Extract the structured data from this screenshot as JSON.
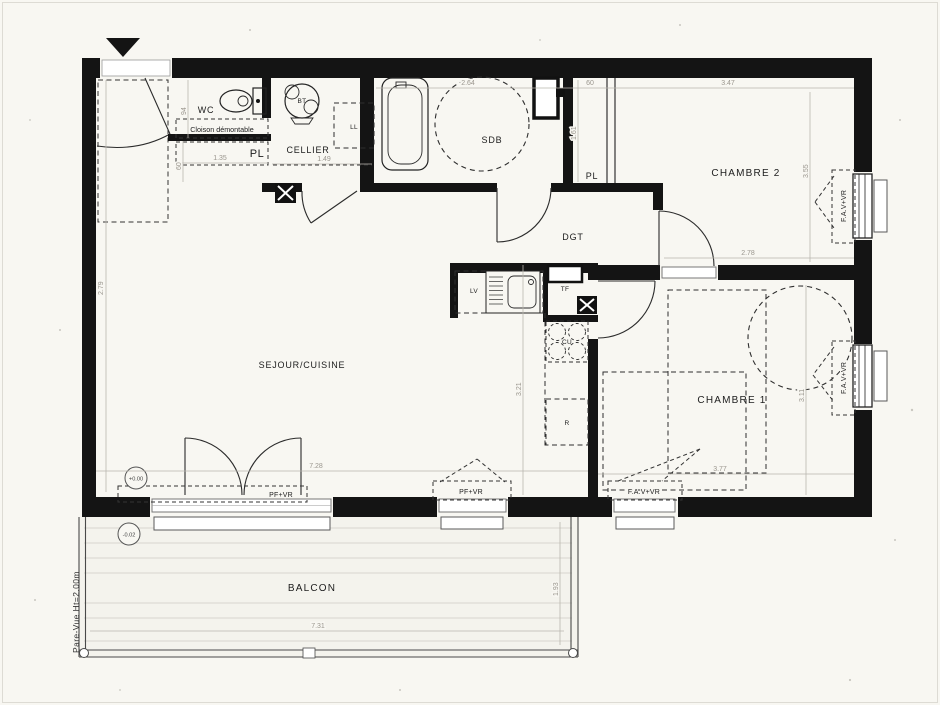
{
  "plan": {
    "rooms": {
      "sejour": "SEJOUR/CUISINE",
      "chambre1": "CHAMBRE 1",
      "chambre2": "CHAMBRE 2",
      "sdb": "SDB",
      "wc": "WC",
      "cellier": "CELLIER",
      "dgt": "DGT",
      "balcon": "BALCON",
      "pl_entry": "PL",
      "pl_chambre2": "PL"
    },
    "equipment": {
      "bt": "BT",
      "ll": "LL",
      "lv": "LV",
      "tf": "TF",
      "cu": "CU",
      "r": "R"
    },
    "openings": {
      "pf_vr": "PF+VR",
      "fav_vr": "F.A.V+VR"
    },
    "notes": {
      "cloison": "Cloison démontable",
      "pare_vue": "Pare-Vue Ht=2.00m"
    },
    "levels": {
      "interior": "+0.00",
      "balcony": "-0.02"
    },
    "dimensions": {
      "sdb_width": "2.64",
      "pl2_width": "60",
      "chambre2_width": "3.47",
      "chambre2_depth": "3.55",
      "chambre2_inner_width": "2.78",
      "chambre1_depth": "3.11",
      "chambre1_width": "3.77",
      "sejour_width": "7.28",
      "sejour_depth": "2.79",
      "kitchen_depth": "3.21",
      "wc_depth": "94",
      "pl_width": "1.35",
      "pl_depth": "60",
      "cellier_width": "1.49",
      "pl2_depth": "1.61",
      "balcon_width": "7.31",
      "balcon_depth": "1.93"
    }
  }
}
